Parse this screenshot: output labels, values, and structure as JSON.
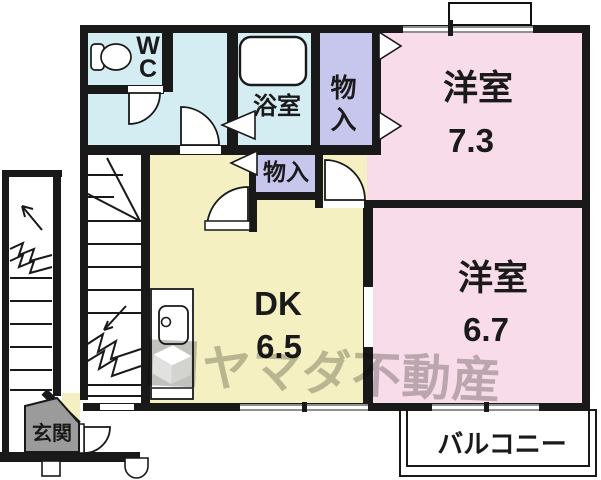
{
  "rooms": {
    "wc": {
      "line1": "W",
      "line2": "C"
    },
    "bath": {
      "name": "浴室"
    },
    "closet_upper": {
      "name": "物入"
    },
    "closet_lower": {
      "name": "物入"
    },
    "western_room_top": {
      "name": "洋室",
      "size": "7.3"
    },
    "western_room_bottom": {
      "name": "洋室",
      "size": "6.7"
    },
    "dining_kitchen": {
      "name": "DK",
      "size": "6.5"
    },
    "entrance": {
      "name": "玄関"
    },
    "balcony": {
      "name": "バルコニー"
    }
  },
  "watermark": {
    "text": "ヤマダ不動産",
    "logo": "yamada-cube-logo"
  },
  "colors": {
    "room_pink": "#f8dcea",
    "room_yellow": "#f5f0c2",
    "room_cyan": "#d4edf3",
    "closet_lavender": "#c7c6ed",
    "entrance_gray": "#9b9b9b",
    "wall_black": "#191919",
    "window_gray": "#8f8f8f",
    "watermark_gray": "#8d8d88"
  }
}
